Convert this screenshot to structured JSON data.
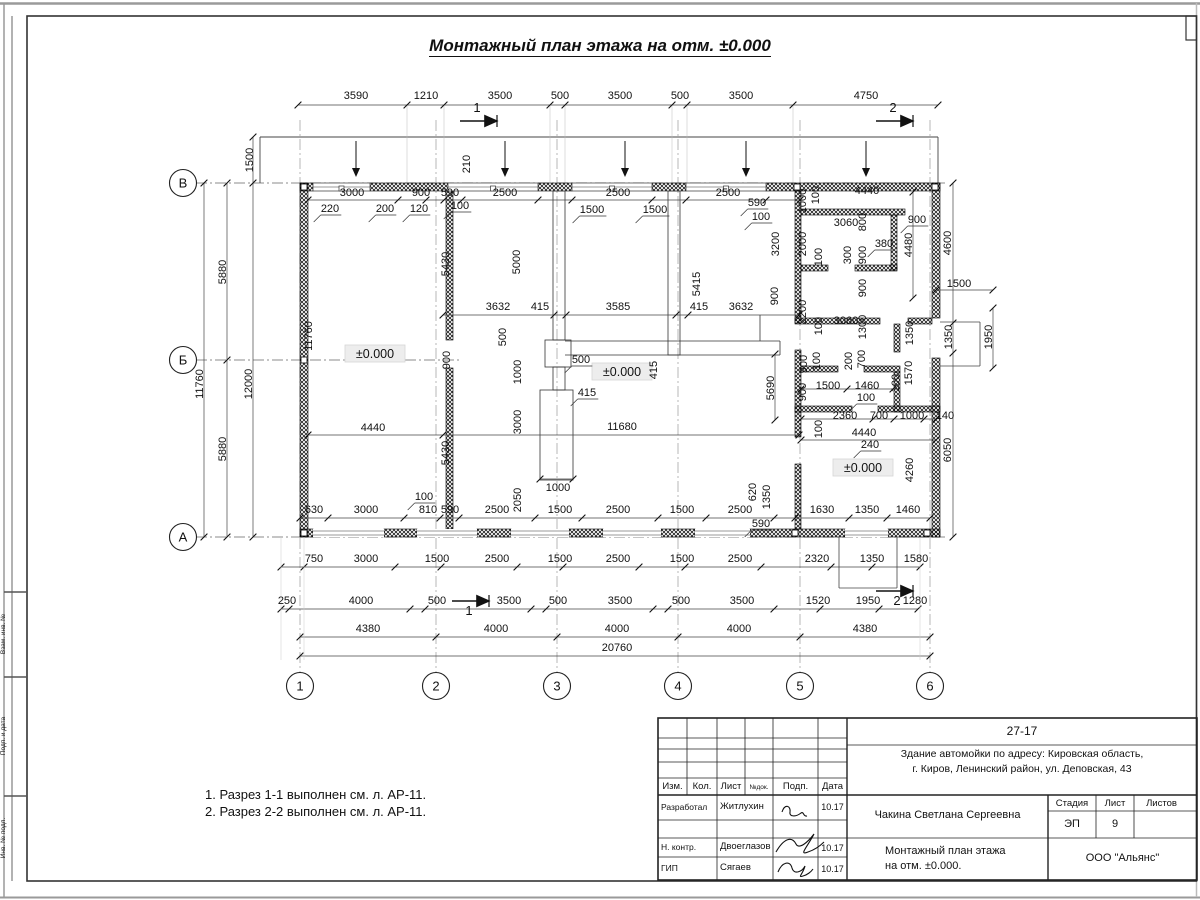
{
  "title": "Монтажный план этажа на отм. ±0.000",
  "notes": [
    "1. Разрез 1-1 выполнен см. л. АР-11.",
    "2. Разрез 2-2 выполнен см. л. АР-11."
  ],
  "margin_labels": [
    "Взам. инв. №",
    "Подп. и дата",
    "Инв. № подл."
  ],
  "axis_rows": [
    {
      "label": "В",
      "x": 183,
      "y": 183
    },
    {
      "label": "Б",
      "x": 183,
      "y": 360
    },
    {
      "label": "А",
      "x": 183,
      "y": 537
    }
  ],
  "axis_cols": [
    {
      "label": "1",
      "x": 300,
      "y": 686
    },
    {
      "label": "2",
      "x": 436,
      "y": 686
    },
    {
      "label": "3",
      "x": 557,
      "y": 686
    },
    {
      "label": "4",
      "x": 678,
      "y": 686
    },
    {
      "label": "5",
      "x": 800,
      "y": 686
    },
    {
      "label": "6",
      "x": 930,
      "y": 686
    }
  ],
  "elevations": [
    {
      "t": "±0.000",
      "x": 375,
      "y": 357
    },
    {
      "t": "±0.000",
      "x": 622,
      "y": 375
    },
    {
      "t": "±0.000",
      "x": 863,
      "y": 471
    }
  ],
  "sections": [
    {
      "t": "1",
      "x": 477,
      "y": 112,
      "ax1": 460,
      "ax2": 497,
      "ay": 121
    },
    {
      "t": "2",
      "x": 893,
      "y": 112,
      "ax1": 876,
      "ax2": 913,
      "ay": 121
    },
    {
      "t": "1",
      "x": 469,
      "y": 615,
      "ax1": 452,
      "ax2": 489,
      "ay": 601
    },
    {
      "t": "2",
      "x": 897,
      "y": 605,
      "ax1": 876,
      "ax2": 913,
      "ay": 591
    }
  ],
  "dims": [
    {
      "t": "3590",
      "x": 356,
      "y": 99
    },
    {
      "t": "1210",
      "x": 426,
      "y": 99
    },
    {
      "t": "3500",
      "x": 500,
      "y": 99
    },
    {
      "t": "500",
      "x": 560,
      "y": 99
    },
    {
      "t": "3500",
      "x": 620,
      "y": 99
    },
    {
      "t": "500",
      "x": 680,
      "y": 99
    },
    {
      "t": "3500",
      "x": 741,
      "y": 99
    },
    {
      "t": "4750",
      "x": 866,
      "y": 99
    },
    {
      "t": "1500",
      "x": 253,
      "y": 160,
      "r": 1
    },
    {
      "t": "210",
      "x": 470,
      "y": 164,
      "r": 1
    },
    {
      "t": "3000",
      "x": 352,
      "y": 196
    },
    {
      "t": "900",
      "x": 421,
      "y": 196
    },
    {
      "t": "590",
      "x": 450,
      "y": 196
    },
    {
      "t": "2500",
      "x": 505,
      "y": 196
    },
    {
      "t": "2500",
      "x": 618,
      "y": 196
    },
    {
      "t": "2500",
      "x": 728,
      "y": 196
    },
    {
      "t": "220",
      "x": 330,
      "y": 212,
      "u": 1
    },
    {
      "t": "200",
      "x": 385,
      "y": 212,
      "u": 1
    },
    {
      "t": "120",
      "x": 419,
      "y": 212,
      "u": 1
    },
    {
      "t": "100",
      "x": 460,
      "y": 209,
      "u": 1
    },
    {
      "t": "1500",
      "x": 592,
      "y": 213,
      "u": 1
    },
    {
      "t": "1500",
      "x": 655,
      "y": 213,
      "u": 1
    },
    {
      "t": "590",
      "x": 757,
      "y": 206,
      "u": 1
    },
    {
      "t": "100",
      "x": 761,
      "y": 220,
      "u": 1
    },
    {
      "t": "5880",
      "x": 226,
      "y": 272,
      "r": 1
    },
    {
      "t": "11760",
      "x": 203,
      "y": 384,
      "r": 1
    },
    {
      "t": "12000",
      "x": 252,
      "y": 384,
      "r": 1
    },
    {
      "t": "5880",
      "x": 226,
      "y": 449,
      "r": 1
    },
    {
      "t": "11760",
      "x": 312,
      "y": 336,
      "r": 1
    },
    {
      "t": "5000",
      "x": 520,
      "y": 262,
      "r": 1
    },
    {
      "t": "5415",
      "x": 700,
      "y": 284,
      "r": 1
    },
    {
      "t": "5430",
      "x": 449,
      "y": 264,
      "r": 1
    },
    {
      "t": "1000",
      "x": 806,
      "y": 201,
      "r": 1
    },
    {
      "t": "100",
      "x": 819,
      "y": 195,
      "r": 1
    },
    {
      "t": "4440",
      "x": 867,
      "y": 194
    },
    {
      "t": "3060",
      "x": 846,
      "y": 226
    },
    {
      "t": "800",
      "x": 866,
      "y": 222,
      "r": 1
    },
    {
      "t": "900",
      "x": 917,
      "y": 223,
      "u": 1
    },
    {
      "t": "380",
      "x": 884,
      "y": 247,
      "u": 1
    },
    {
      "t": "4480",
      "x": 912,
      "y": 245,
      "r": 1
    },
    {
      "t": "4600",
      "x": 951,
      "y": 243,
      "r": 1
    },
    {
      "t": "3200",
      "x": 779,
      "y": 244,
      "r": 1
    },
    {
      "t": "2000",
      "x": 806,
      "y": 244,
      "r": 1
    },
    {
      "t": "100",
      "x": 822,
      "y": 257,
      "r": 1
    },
    {
      "t": "300",
      "x": 851,
      "y": 255,
      "r": 1
    },
    {
      "t": "900",
      "x": 866,
      "y": 255,
      "r": 1
    },
    {
      "t": "900",
      "x": 778,
      "y": 296,
      "r": 1
    },
    {
      "t": "900",
      "x": 866,
      "y": 288,
      "r": 1
    },
    {
      "t": "2200",
      "x": 806,
      "y": 312,
      "r": 1
    },
    {
      "t": "100",
      "x": 822,
      "y": 326,
      "r": 1
    },
    {
      "t": "3060",
      "x": 846,
      "y": 324
    },
    {
      "t": "1300",
      "x": 866,
      "y": 327,
      "r": 1
    },
    {
      "t": "1500",
      "x": 959,
      "y": 287
    },
    {
      "t": "1350",
      "x": 913,
      "y": 333,
      "r": 1
    },
    {
      "t": "1350",
      "x": 952,
      "y": 337,
      "r": 1
    },
    {
      "t": "1950",
      "x": 992,
      "y": 337,
      "r": 1
    },
    {
      "t": "900",
      "x": 807,
      "y": 364,
      "r": 1
    },
    {
      "t": "100",
      "x": 820,
      "y": 361,
      "r": 1
    },
    {
      "t": "200",
      "x": 852,
      "y": 361,
      "r": 1
    },
    {
      "t": "700",
      "x": 865,
      "y": 359,
      "r": 1
    },
    {
      "t": "1500",
      "x": 828,
      "y": 389
    },
    {
      "t": "1460",
      "x": 867,
      "y": 389
    },
    {
      "t": "100",
      "x": 866,
      "y": 401,
      "u": 1
    },
    {
      "t": "900",
      "x": 806,
      "y": 392,
      "r": 1
    },
    {
      "t": "1570",
      "x": 912,
      "y": 373,
      "r": 1
    },
    {
      "t": "100",
      "x": 899,
      "y": 383,
      "r": 1
    },
    {
      "t": "2360",
      "x": 845,
      "y": 419
    },
    {
      "t": "700",
      "x": 879,
      "y": 419
    },
    {
      "t": "1000",
      "x": 912,
      "y": 419
    },
    {
      "t": "140",
      "x": 945,
      "y": 419
    },
    {
      "t": "100",
      "x": 822,
      "y": 429,
      "r": 1
    },
    {
      "t": "4440",
      "x": 864,
      "y": 436
    },
    {
      "t": "240",
      "x": 870,
      "y": 448,
      "u": 1
    },
    {
      "t": "4260",
      "x": 913,
      "y": 470,
      "r": 1
    },
    {
      "t": "6050",
      "x": 951,
      "y": 450,
      "r": 1
    },
    {
      "t": "3632",
      "x": 498,
      "y": 310
    },
    {
      "t": "415",
      "x": 540,
      "y": 310
    },
    {
      "t": "3585",
      "x": 618,
      "y": 310
    },
    {
      "t": "415",
      "x": 699,
      "y": 310
    },
    {
      "t": "3632",
      "x": 741,
      "y": 310
    },
    {
      "t": "500",
      "x": 506,
      "y": 337,
      "r": 1
    },
    {
      "t": "900",
      "x": 450,
      "y": 360,
      "r": 1
    },
    {
      "t": "1000",
      "x": 521,
      "y": 372,
      "r": 1
    },
    {
      "t": "500",
      "x": 581,
      "y": 363,
      "u": 1
    },
    {
      "t": "415",
      "x": 657,
      "y": 370,
      "r": 1
    },
    {
      "t": "415",
      "x": 587,
      "y": 396,
      "u": 1
    },
    {
      "t": "3000",
      "x": 521,
      "y": 422,
      "r": 1
    },
    {
      "t": "11680",
      "x": 622,
      "y": 430
    },
    {
      "t": "5430",
      "x": 449,
      "y": 453,
      "r": 1
    },
    {
      "t": "2050",
      "x": 521,
      "y": 500,
      "r": 1
    },
    {
      "t": "1000",
      "x": 558,
      "y": 491
    },
    {
      "t": "5690",
      "x": 774,
      "y": 388,
      "r": 1
    },
    {
      "t": "620",
      "x": 756,
      "y": 492,
      "r": 1
    },
    {
      "t": "1350",
      "x": 770,
      "y": 497,
      "r": 1
    },
    {
      "t": "590",
      "x": 761,
      "y": 527,
      "u": 1
    },
    {
      "t": "4440",
      "x": 373,
      "y": 431
    },
    {
      "t": "100",
      "x": 424,
      "y": 500,
      "u": 1
    },
    {
      "t": "630",
      "x": 314,
      "y": 513
    },
    {
      "t": "3000",
      "x": 366,
      "y": 513
    },
    {
      "t": "810",
      "x": 428,
      "y": 513
    },
    {
      "t": "590",
      "x": 450,
      "y": 513
    },
    {
      "t": "2500",
      "x": 497,
      "y": 513
    },
    {
      "t": "1500",
      "x": 560,
      "y": 513
    },
    {
      "t": "2500",
      "x": 618,
      "y": 513
    },
    {
      "t": "1500",
      "x": 682,
      "y": 513
    },
    {
      "t": "2500",
      "x": 740,
      "y": 513
    },
    {
      "t": "1630",
      "x": 822,
      "y": 513
    },
    {
      "t": "1350",
      "x": 867,
      "y": 513
    },
    {
      "t": "1460",
      "x": 908,
      "y": 513
    },
    {
      "t": "750",
      "x": 314,
      "y": 562
    },
    {
      "t": "3000",
      "x": 366,
      "y": 562
    },
    {
      "t": "1500",
      "x": 437,
      "y": 562
    },
    {
      "t": "2500",
      "x": 497,
      "y": 562
    },
    {
      "t": "1500",
      "x": 560,
      "y": 562
    },
    {
      "t": "2500",
      "x": 618,
      "y": 562
    },
    {
      "t": "1500",
      "x": 682,
      "y": 562
    },
    {
      "t": "2500",
      "x": 740,
      "y": 562
    },
    {
      "t": "2320",
      "x": 817,
      "y": 562
    },
    {
      "t": "1350",
      "x": 872,
      "y": 562
    },
    {
      "t": "1580",
      "x": 916,
      "y": 562
    },
    {
      "t": "250",
      "x": 287,
      "y": 604
    },
    {
      "t": "4000",
      "x": 361,
      "y": 604
    },
    {
      "t": "500",
      "x": 437,
      "y": 604
    },
    {
      "t": "3500",
      "x": 509,
      "y": 604
    },
    {
      "t": "500",
      "x": 558,
      "y": 604
    },
    {
      "t": "3500",
      "x": 620,
      "y": 604
    },
    {
      "t": "500",
      "x": 681,
      "y": 604
    },
    {
      "t": "3500",
      "x": 742,
      "y": 604
    },
    {
      "t": "1520",
      "x": 818,
      "y": 604
    },
    {
      "t": "1950",
      "x": 868,
      "y": 604
    },
    {
      "t": "1280",
      "x": 915,
      "y": 604
    },
    {
      "t": "4380",
      "x": 368,
      "y": 632
    },
    {
      "t": "4000",
      "x": 496,
      "y": 632
    },
    {
      "t": "4000",
      "x": 617,
      "y": 632
    },
    {
      "t": "4000",
      "x": 739,
      "y": 632
    },
    {
      "t": "4380",
      "x": 865,
      "y": 632
    },
    {
      "t": "20760",
      "x": 617,
      "y": 651
    }
  ],
  "titleblock": {
    "doc_no": "27-17",
    "object_line1": "Здание автомойки по адресу: Кировская область,",
    "object_line2": "г. Киров, Ленинский район, ул. Деповская, 43",
    "cols": {
      "c1": "Изм.",
      "c2": "Кол.",
      "c3": "Лист",
      "c4": "№док.",
      "c5": "Подп.",
      "c6": "Дата"
    },
    "rows": [
      {
        "role": "Разработал",
        "name": "Житлухин",
        "date": "10.17"
      },
      {
        "role": "Н. контр.",
        "name": "Двоеглазов",
        "date": "10.17"
      },
      {
        "role": "ГИП",
        "name": "Сягаев",
        "date": "10.17"
      }
    ],
    "author": "Чакина Светлана Сергеевна",
    "sheet_title1": "Монтажный план этажа",
    "sheet_title2": "на отм. ±0.000.",
    "stage_label": "Стадия",
    "sheet_label": "Лист",
    "sheets_label": "Листов",
    "stage": "ЭП",
    "sheet_no": "9",
    "company": "ООО \"Альянс\""
  }
}
